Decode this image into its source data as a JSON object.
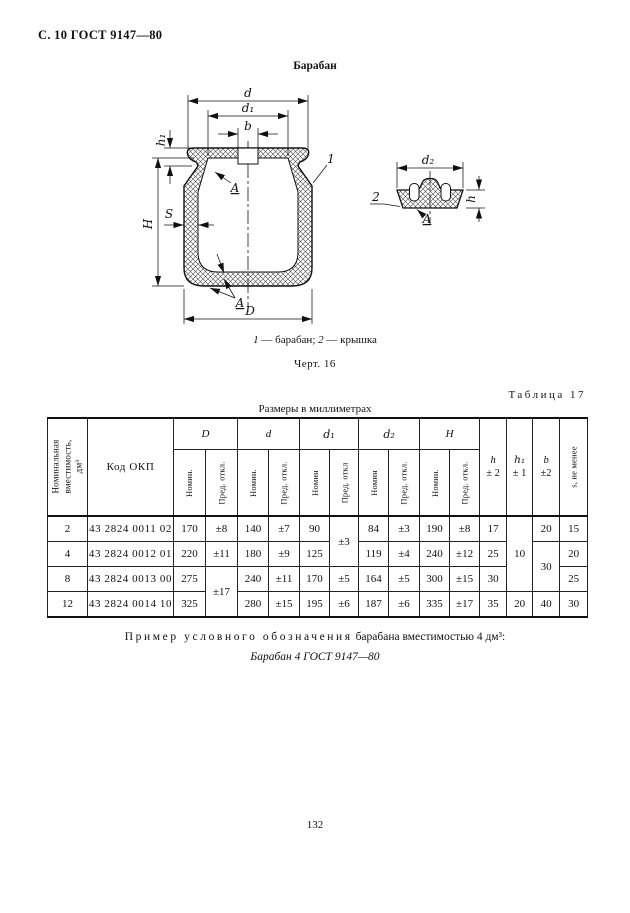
{
  "page": {
    "header": "С. 10 ГОСТ 9147—80",
    "number": "132"
  },
  "figure": {
    "title": "Барабан",
    "caption_1_num": "1",
    "caption_1_text": " — барабан; ",
    "caption_2_num": "2",
    "caption_2_text": " — крышка",
    "fig_label": "Черт. 16",
    "labels": {
      "d": "d",
      "d1": "d₁",
      "b": "b",
      "h1": "h₁",
      "H": "H",
      "S": "S",
      "D": "D",
      "A_top": "A",
      "A_bottom": "A",
      "part1": "1",
      "d2": "d₂",
      "h": "h",
      "part2": "2",
      "A_lid": "A"
    }
  },
  "table": {
    "caption": "Таблица 17",
    "units": "Размеры в миллиметрах",
    "headers": {
      "capacity": "Номинальная вместимость, дм³",
      "okp": "Код ОКП",
      "groups": [
        {
          "label": "D"
        },
        {
          "label": "d"
        },
        {
          "label": "d₁"
        },
        {
          "label": "d₂"
        },
        {
          "label": "Н"
        }
      ],
      "sub": [
        "Номин.",
        "Пред. откл.",
        "Номин.",
        "Пред. откл.",
        "Номин",
        "Пред. откл",
        "Номин",
        "Пред. откл.",
        "Номин.",
        "Пред. откл."
      ],
      "h_label": "h",
      "h_tol": "± 2",
      "h1_label": "h₁",
      "h1_tol": "± 1",
      "b_label": "b",
      "b_tol": "±2",
      "s": "s, не менее"
    },
    "rows": [
      {
        "cap": "2",
        "okp": "43 2824 0011 02",
        "D_nom": "170",
        "D_tol": "±8",
        "d_nom": "140",
        "d_tol": "±7",
        "d1_nom": "90",
        "d1_tol": "±3",
        "d2_nom": "84",
        "d2_tol": "±3",
        "H_nom": "190",
        "H_tol": "±8",
        "h": "17",
        "h1": "10",
        "b": "20",
        "s": "15"
      },
      {
        "cap": "4",
        "okp": "43 2824 0012 01",
        "D_nom": "220",
        "D_tol": "±11",
        "d_nom": "180",
        "d_tol": "±9",
        "d1_nom": "125",
        "d2_nom": "119",
        "d2_tol": "±4",
        "H_nom": "240",
        "H_tol": "±12",
        "h": "25",
        "b": "30",
        "s": "20"
      },
      {
        "cap": "8",
        "okp": "43 2824 0013 00",
        "D_nom": "275",
        "D_tol": "±17",
        "d_nom": "240",
        "d_tol": "±11",
        "d1_nom": "170",
        "d1_tol": "±5",
        "d2_nom": "164",
        "d2_tol": "±5",
        "H_nom": "300",
        "H_tol": "±15",
        "h": "30",
        "s": "25"
      },
      {
        "cap": "12",
        "okp": "43 2824 0014 10",
        "D_nom": "325",
        "d_nom": "280",
        "d_tol": "±15",
        "d1_nom": "195",
        "d1_tol": "±6",
        "d2_nom": "187",
        "d2_tol": "±6",
        "H_nom": "335",
        "H_tol": "±17",
        "h": "35",
        "h1": "20",
        "b": "40",
        "s": "30"
      }
    ]
  },
  "example": {
    "lead": "Пример условного обозначения",
    "rest": " барабана вместимостью 4 дм³:",
    "designation": "Барабан 4 ГОСТ 9147—80"
  }
}
